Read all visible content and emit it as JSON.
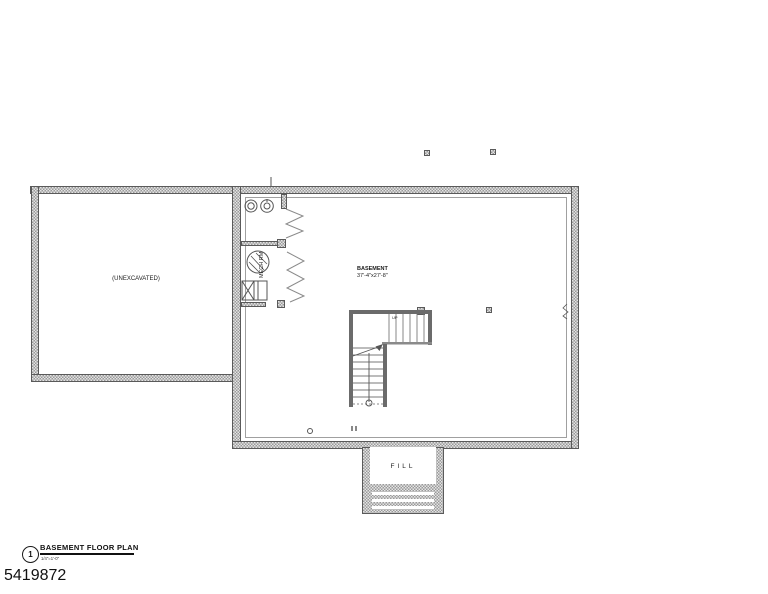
{
  "drawing": {
    "number": "5419872",
    "sheet_ref": "1",
    "title": "BASEMENT FLOOR PLAN",
    "scale": "1/4\"=1'-0\"",
    "labels": {
      "unexcavated": "(UNEXCAVATED)",
      "basement_name": "BASEMENT",
      "basement_dims": "37'-4\"x27'-8\"",
      "mech_room": "MECH RM",
      "fill": "FILL",
      "stair_direction": "UP"
    },
    "colors": {
      "paper": "#ffffff",
      "ink": "#3f3f3f",
      "wall_hatch_dark": "#9a9a9a",
      "wall_hatch_light": "#e4e4e4"
    }
  }
}
